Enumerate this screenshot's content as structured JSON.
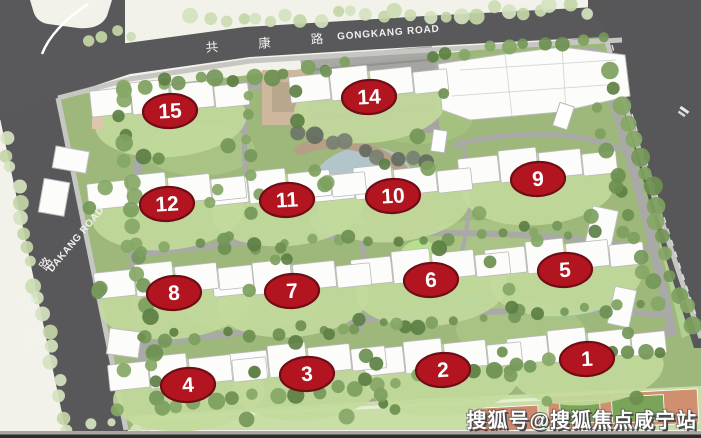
{
  "page": {
    "watermark": "搜狐号@搜狐焦点咸宁站"
  },
  "roads": {
    "gongkang": {
      "zh": "共 康 路",
      "en": "GONGKANG ROAD"
    },
    "dakang": {
      "zh_chars": [
        "大",
        "康",
        "路"
      ],
      "en": "DAKANG ROAD"
    }
  },
  "badges": [
    {
      "label": "1",
      "x": 587,
      "y": 359
    },
    {
      "label": "2",
      "x": 443,
      "y": 370
    },
    {
      "label": "3",
      "x": 307,
      "y": 374
    },
    {
      "label": "4",
      "x": 188,
      "y": 385
    },
    {
      "label": "5",
      "x": 565,
      "y": 270
    },
    {
      "label": "6",
      "x": 431,
      "y": 280
    },
    {
      "label": "7",
      "x": 292,
      "y": 291
    },
    {
      "label": "8",
      "x": 174,
      "y": 293
    },
    {
      "label": "9",
      "x": 538,
      "y": 179
    },
    {
      "label": "10",
      "x": 393,
      "y": 196
    },
    {
      "label": "11",
      "x": 287,
      "y": 200
    },
    {
      "label": "12",
      "x": 167,
      "y": 204
    },
    {
      "label": "14",
      "x": 369,
      "y": 97
    },
    {
      "label": "15",
      "x": 170,
      "y": 111
    }
  ],
  "colors": {
    "background": "#f2f1ea",
    "road": "#59595b",
    "sidewalk": "#c6c6c3",
    "site_green": "#9db87a",
    "lawn": "#c2da9b",
    "tree_dark": "#6d8f50",
    "tree_light": "#ccdcb2",
    "water": "#b2c5cb",
    "island_tan": "#b19e85",
    "building_white": "#fcfcfa",
    "court_terracotta": "#d09070",
    "court_green": "#7ba45b",
    "badge_fill": "#b2151f",
    "badge_stroke": "#6f0d16",
    "badge_text": "#ffffff",
    "road_label_text": "#f2f2f2",
    "watermark_text": "#ffffff",
    "watermark_shadow": "#474747"
  }
}
